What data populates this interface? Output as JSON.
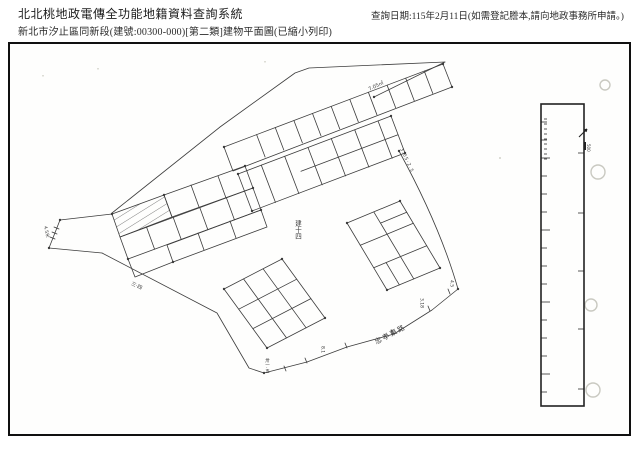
{
  "header": {
    "system_title": "北北桃地政電傳全功能地籍資料查詢系統",
    "document_subtitle": "新北市汐止區同新段(建號:00300-000)[第二類]建物平面圖(已縮小列印)",
    "query_date_note": "查詢日期:115年2月11日(如需登記謄本,請向地政事務所申請。)"
  },
  "plan": {
    "building_number_label": "建十四",
    "road_name_label": "忠孝東路",
    "handwritten_notes": {
      "area_note": "7.05㎡",
      "curve_dimension_note": "3.05·2.5",
      "southwest_dimension_note": "三·四",
      "bottom_dimension_note_1": "卅一.五",
      "bottom_dimension_note_2": "8.1",
      "east_dimension_note_1": "3.18",
      "east_dimension_note_2": "4.5",
      "left_dimension_note": "4.5米",
      "scale_bar_note": "500"
    }
  }
}
